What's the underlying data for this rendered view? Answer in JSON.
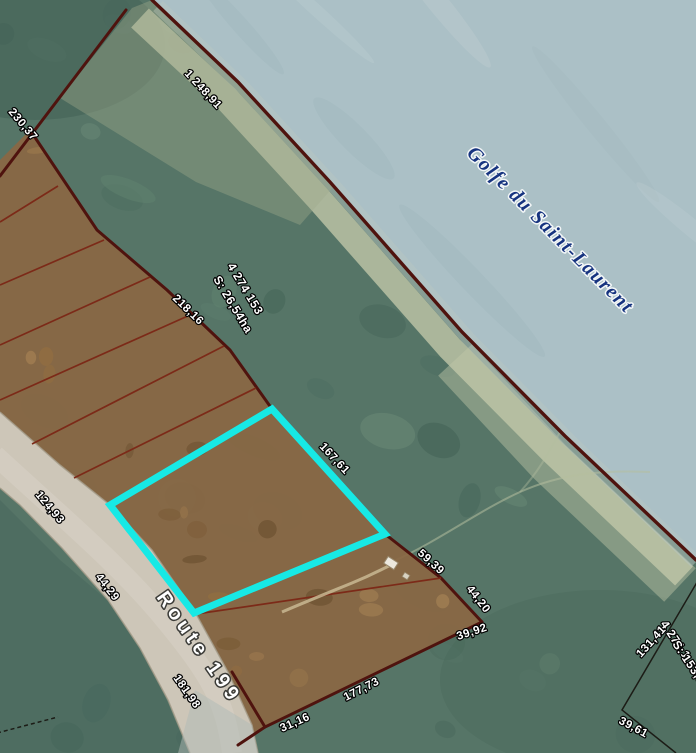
{
  "colors": {
    "water": "#abc0c6",
    "water_text": "#16337f",
    "land": "#567567",
    "sand": "#c1c7a9",
    "parcel_fill": "#8a6743",
    "road_fill": "#cdc6b8",
    "boundary": "#4f130e",
    "division": "#7c2a18",
    "highlight": "#17e9e5",
    "survey_line": "#1c1c16"
  },
  "labels": {
    "water_body": "Golfe du Saint-Laurent",
    "road": "Route 199",
    "main_lot": {
      "number": "4 274 153",
      "area": "S: 26,54ha"
    },
    "right_lot": {
      "number": "4 274 1",
      "area": "S: 153,8"
    },
    "dims": [
      "1 248,91",
      "230,37",
      "218,16",
      "167,61",
      "124,93",
      "44,29",
      "181,98",
      "59,39",
      "44,20",
      "39,92",
      "177,73",
      "31,16",
      "131,41",
      "39,61"
    ]
  }
}
